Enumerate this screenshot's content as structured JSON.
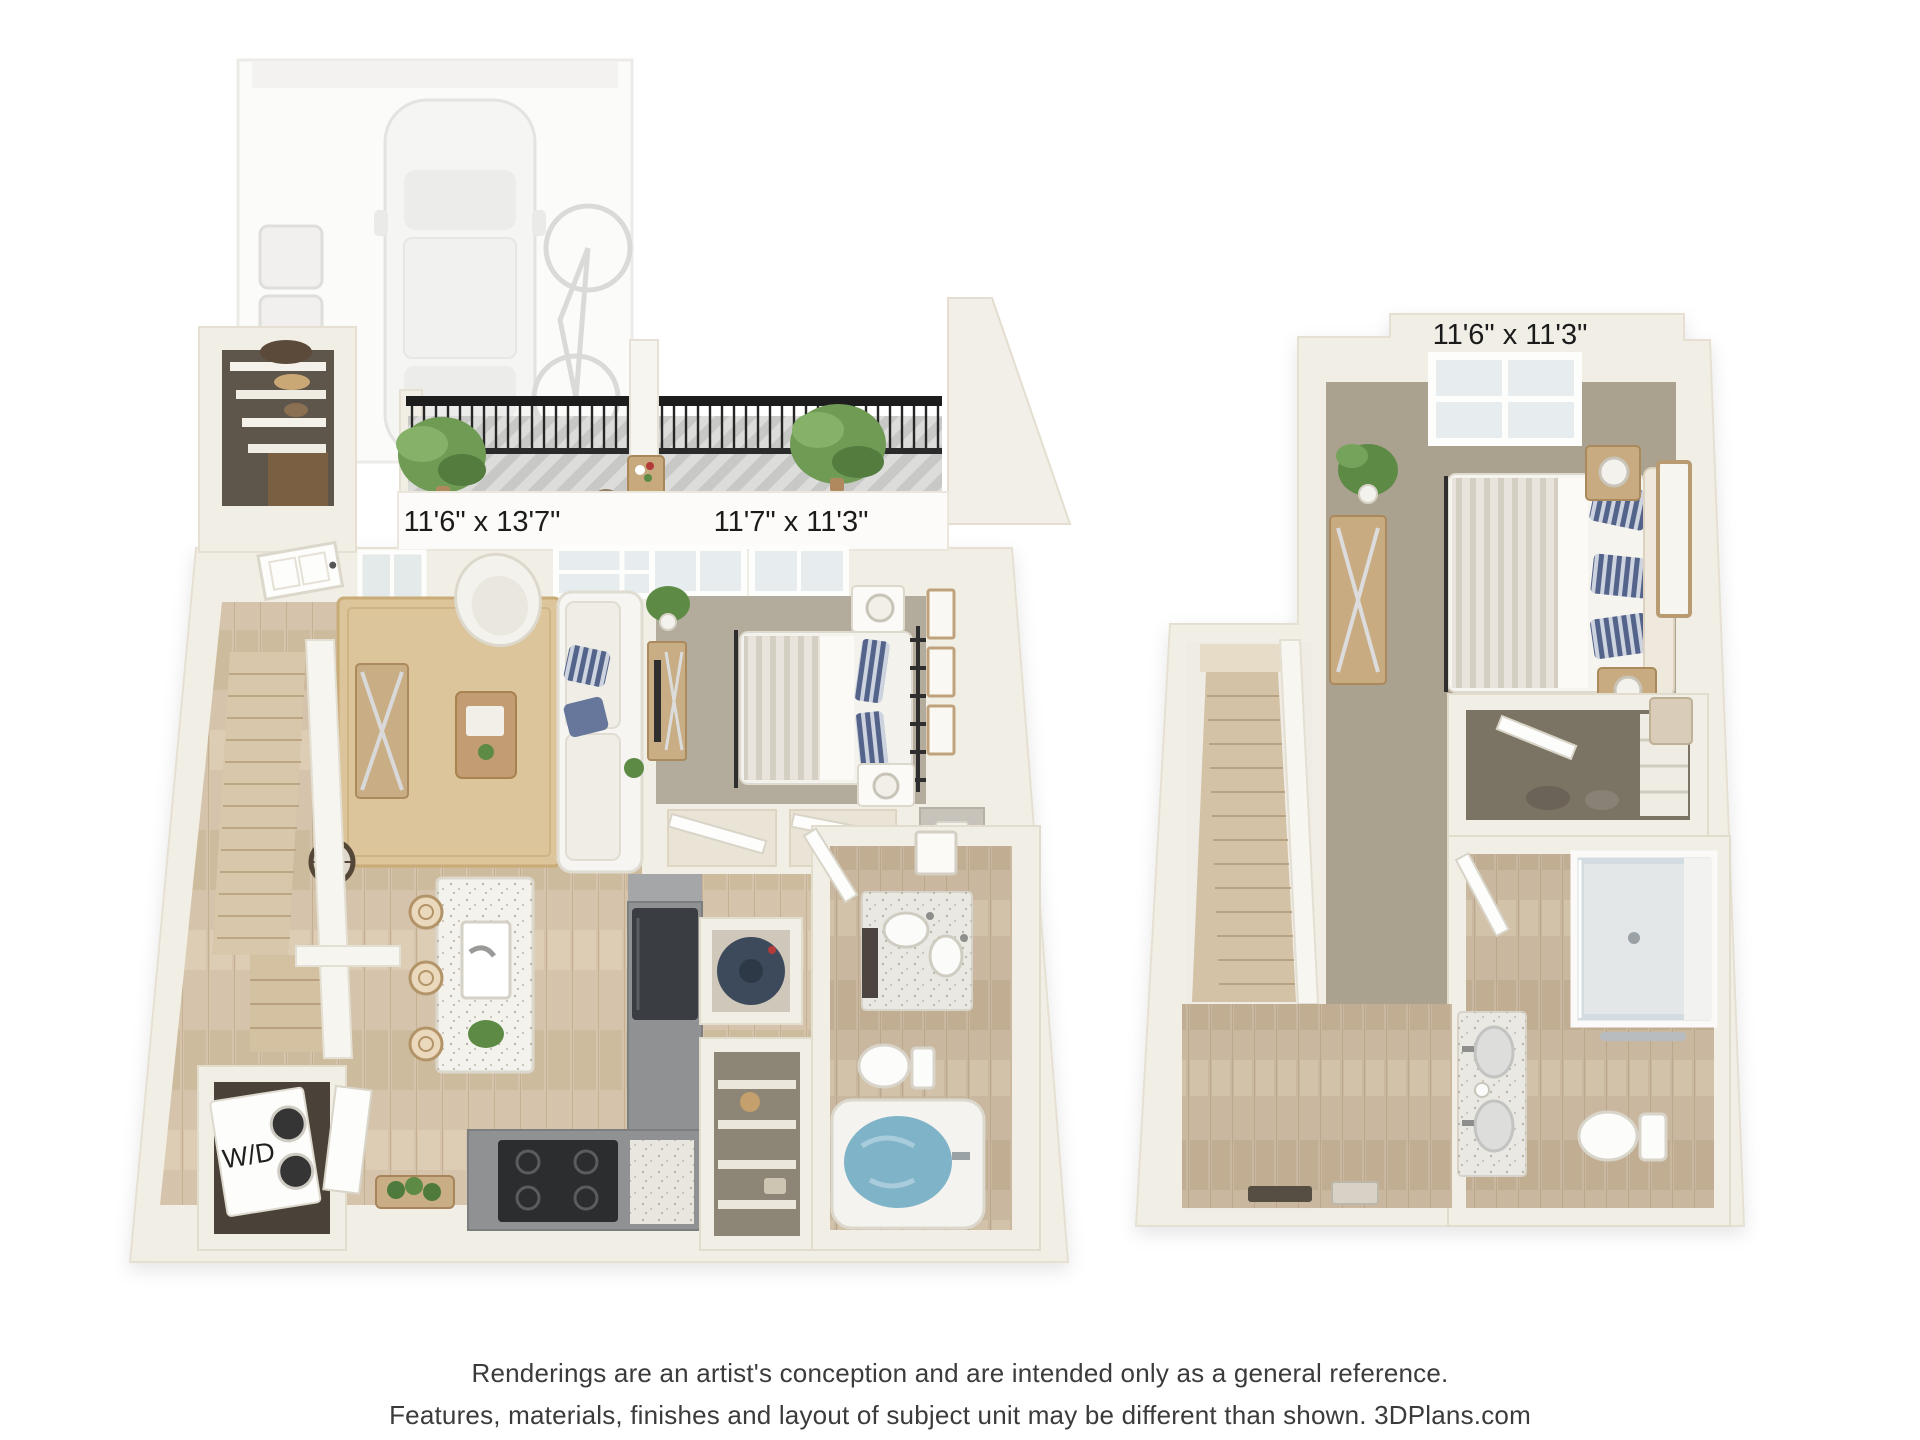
{
  "plans": {
    "first_floor": {
      "living_dining_label": "11'6\" x 13'7\"",
      "bedroom_label": "11'7\" x 11'3\"",
      "washer_dryer_label": "W/D"
    },
    "second_floor": {
      "bedroom_label": "11'6\" x 11'3\""
    }
  },
  "disclaimer": {
    "line1": "Renderings are an artist's conception and are intended only as a general reference.",
    "line2": "Features, materials, finishes and layout of subject unit may be different than shown. 3DPlans.com"
  },
  "colors": {
    "wall": "#f1eee6",
    "wood_floor": "#d5c4ab",
    "bedroom_carpet": "#b3ab9b",
    "upper_carpet": "#aaa28e",
    "closet_carpet": "#7b7363",
    "deck": "#dbdbd9",
    "railing": "#1d1d1d",
    "kitchen_counter": "#8f9193",
    "tub_water": "#7fb3c8",
    "label_text": "#1b1b1b"
  }
}
